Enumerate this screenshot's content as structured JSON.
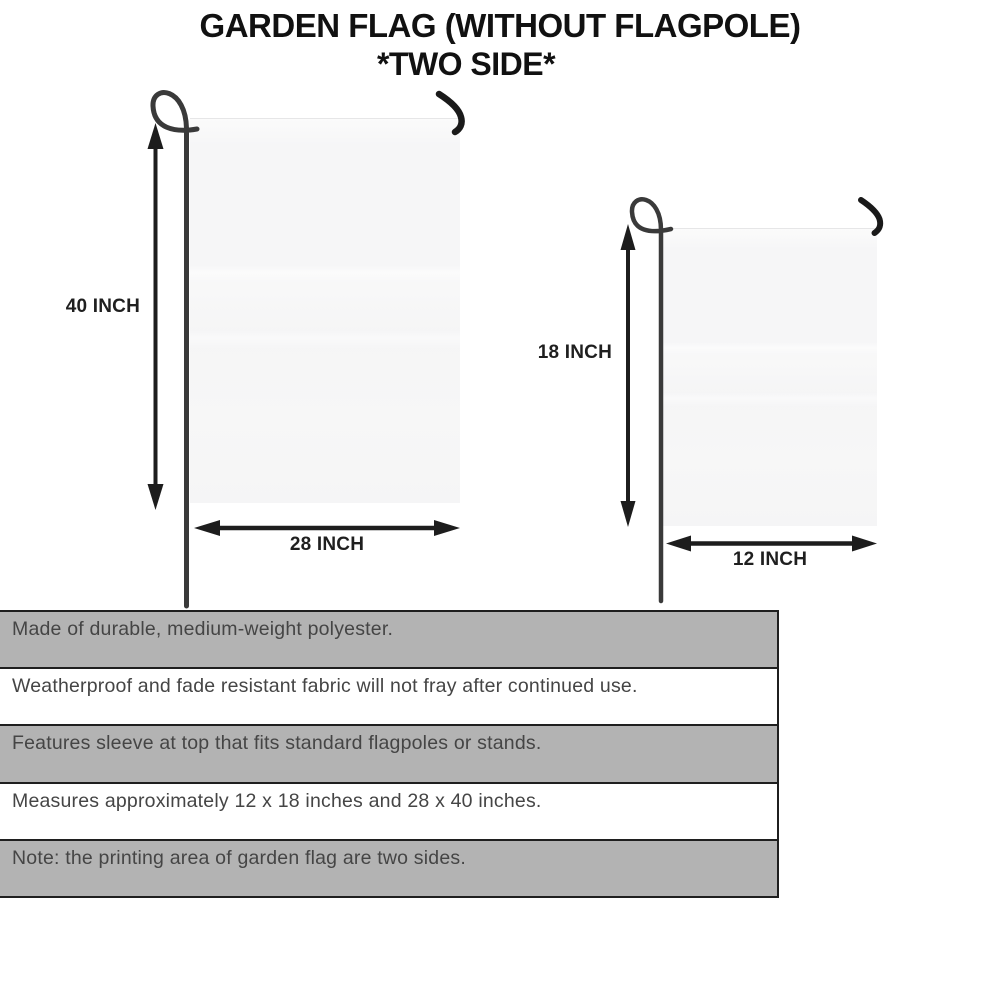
{
  "title": {
    "line1": "GARDEN FLAG (WITHOUT FLAGPOLE)",
    "line2": "*TWO SIDE*"
  },
  "diagram": {
    "large_flag": {
      "height_label": "40 INCH",
      "width_label": "28 INCH"
    },
    "small_flag": {
      "height_label": "18 INCH",
      "width_label": "12 INCH"
    }
  },
  "features": [
    {
      "text": "Made of durable, medium-weight polyester."
    },
    {
      "text": "Weatherproof and fade resistant fabric will not fray after continued use."
    },
    {
      "text": "Features sleeve at top that fits standard flagpoles or stands."
    },
    {
      "text": "Measures approximately 12 x 18 inches and 28 x 40 inches."
    },
    {
      "text": "Note: the printing area of garden flag are two sides."
    }
  ],
  "colors": {
    "row_gray": "#b3b3b3",
    "row_white": "#ffffff",
    "border_black": "#1f1f1f",
    "flag_fill": "#f6f6f7",
    "pole_dark": "#3a3a3a",
    "title_black": "#111111",
    "feature_text": "#454545"
  }
}
